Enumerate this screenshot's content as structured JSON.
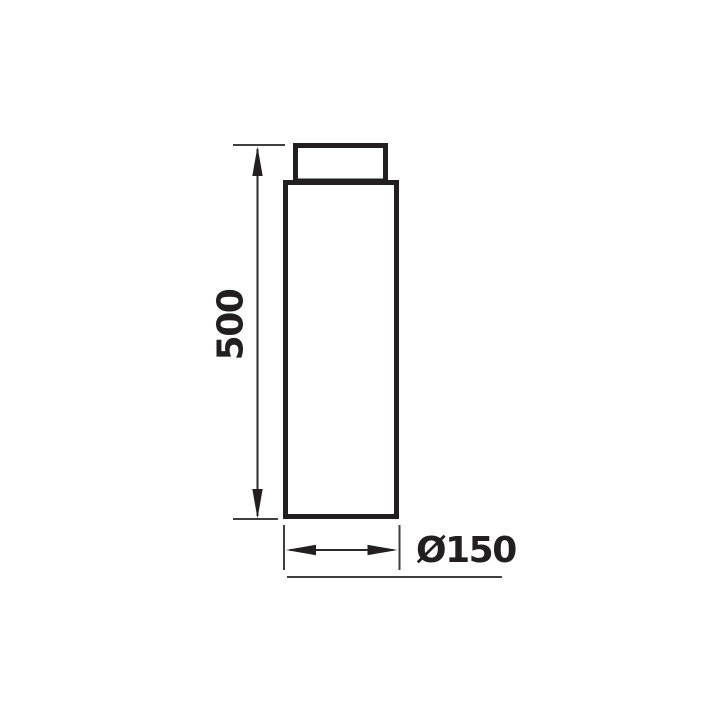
{
  "colors": {
    "background": "#ffffff",
    "ink": "#231f20",
    "thin_line": "#3f3f3f"
  },
  "drawing": {
    "height_dimension": {
      "label": "500"
    },
    "diameter_dimension": {
      "label": "Ø150"
    }
  }
}
